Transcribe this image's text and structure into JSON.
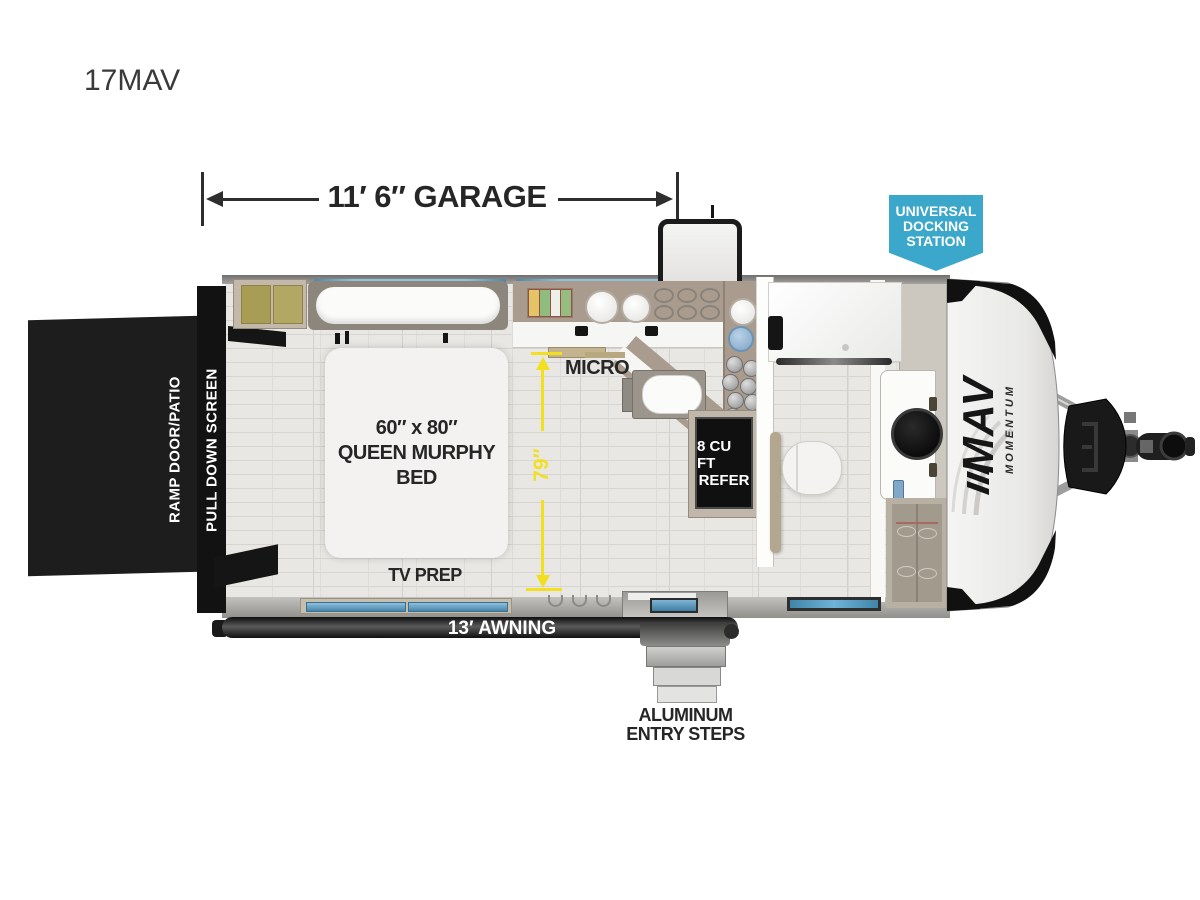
{
  "model": {
    "title": "17MAV"
  },
  "dimensions": {
    "garage": "11′ 6″ GARAGE",
    "height": "79″",
    "awning": "13′ AWNING"
  },
  "docking_badge": {
    "line1": "UNIVERSAL",
    "line2": "DOCKING",
    "line3": "STATION",
    "color": "#3ba7ca"
  },
  "ramp": {
    "label1": "RAMP DOOR/PATIO",
    "label2": "PULL DOWN SCREEN"
  },
  "kitchen": {
    "micro": "MICRO"
  },
  "bed": {
    "line1": "60″ x 80″",
    "line2": "QUEEN MURPHY",
    "line3": "BED",
    "tv_prep": "TV PREP"
  },
  "fridge": {
    "line1": "8 CU FT",
    "line2": "REFER"
  },
  "steps": {
    "line1": "ALUMINUM",
    "line2": "ENTRY STEPS"
  },
  "front_cap": {
    "logo": "MAV",
    "logo_sub": "MOMENTUM"
  },
  "colors": {
    "accent_yellow": "#f2df1f",
    "badge_blue": "#3ba7ca",
    "counter_taupe": "#a99c8e",
    "floor_gray": "#e8e7e4"
  }
}
